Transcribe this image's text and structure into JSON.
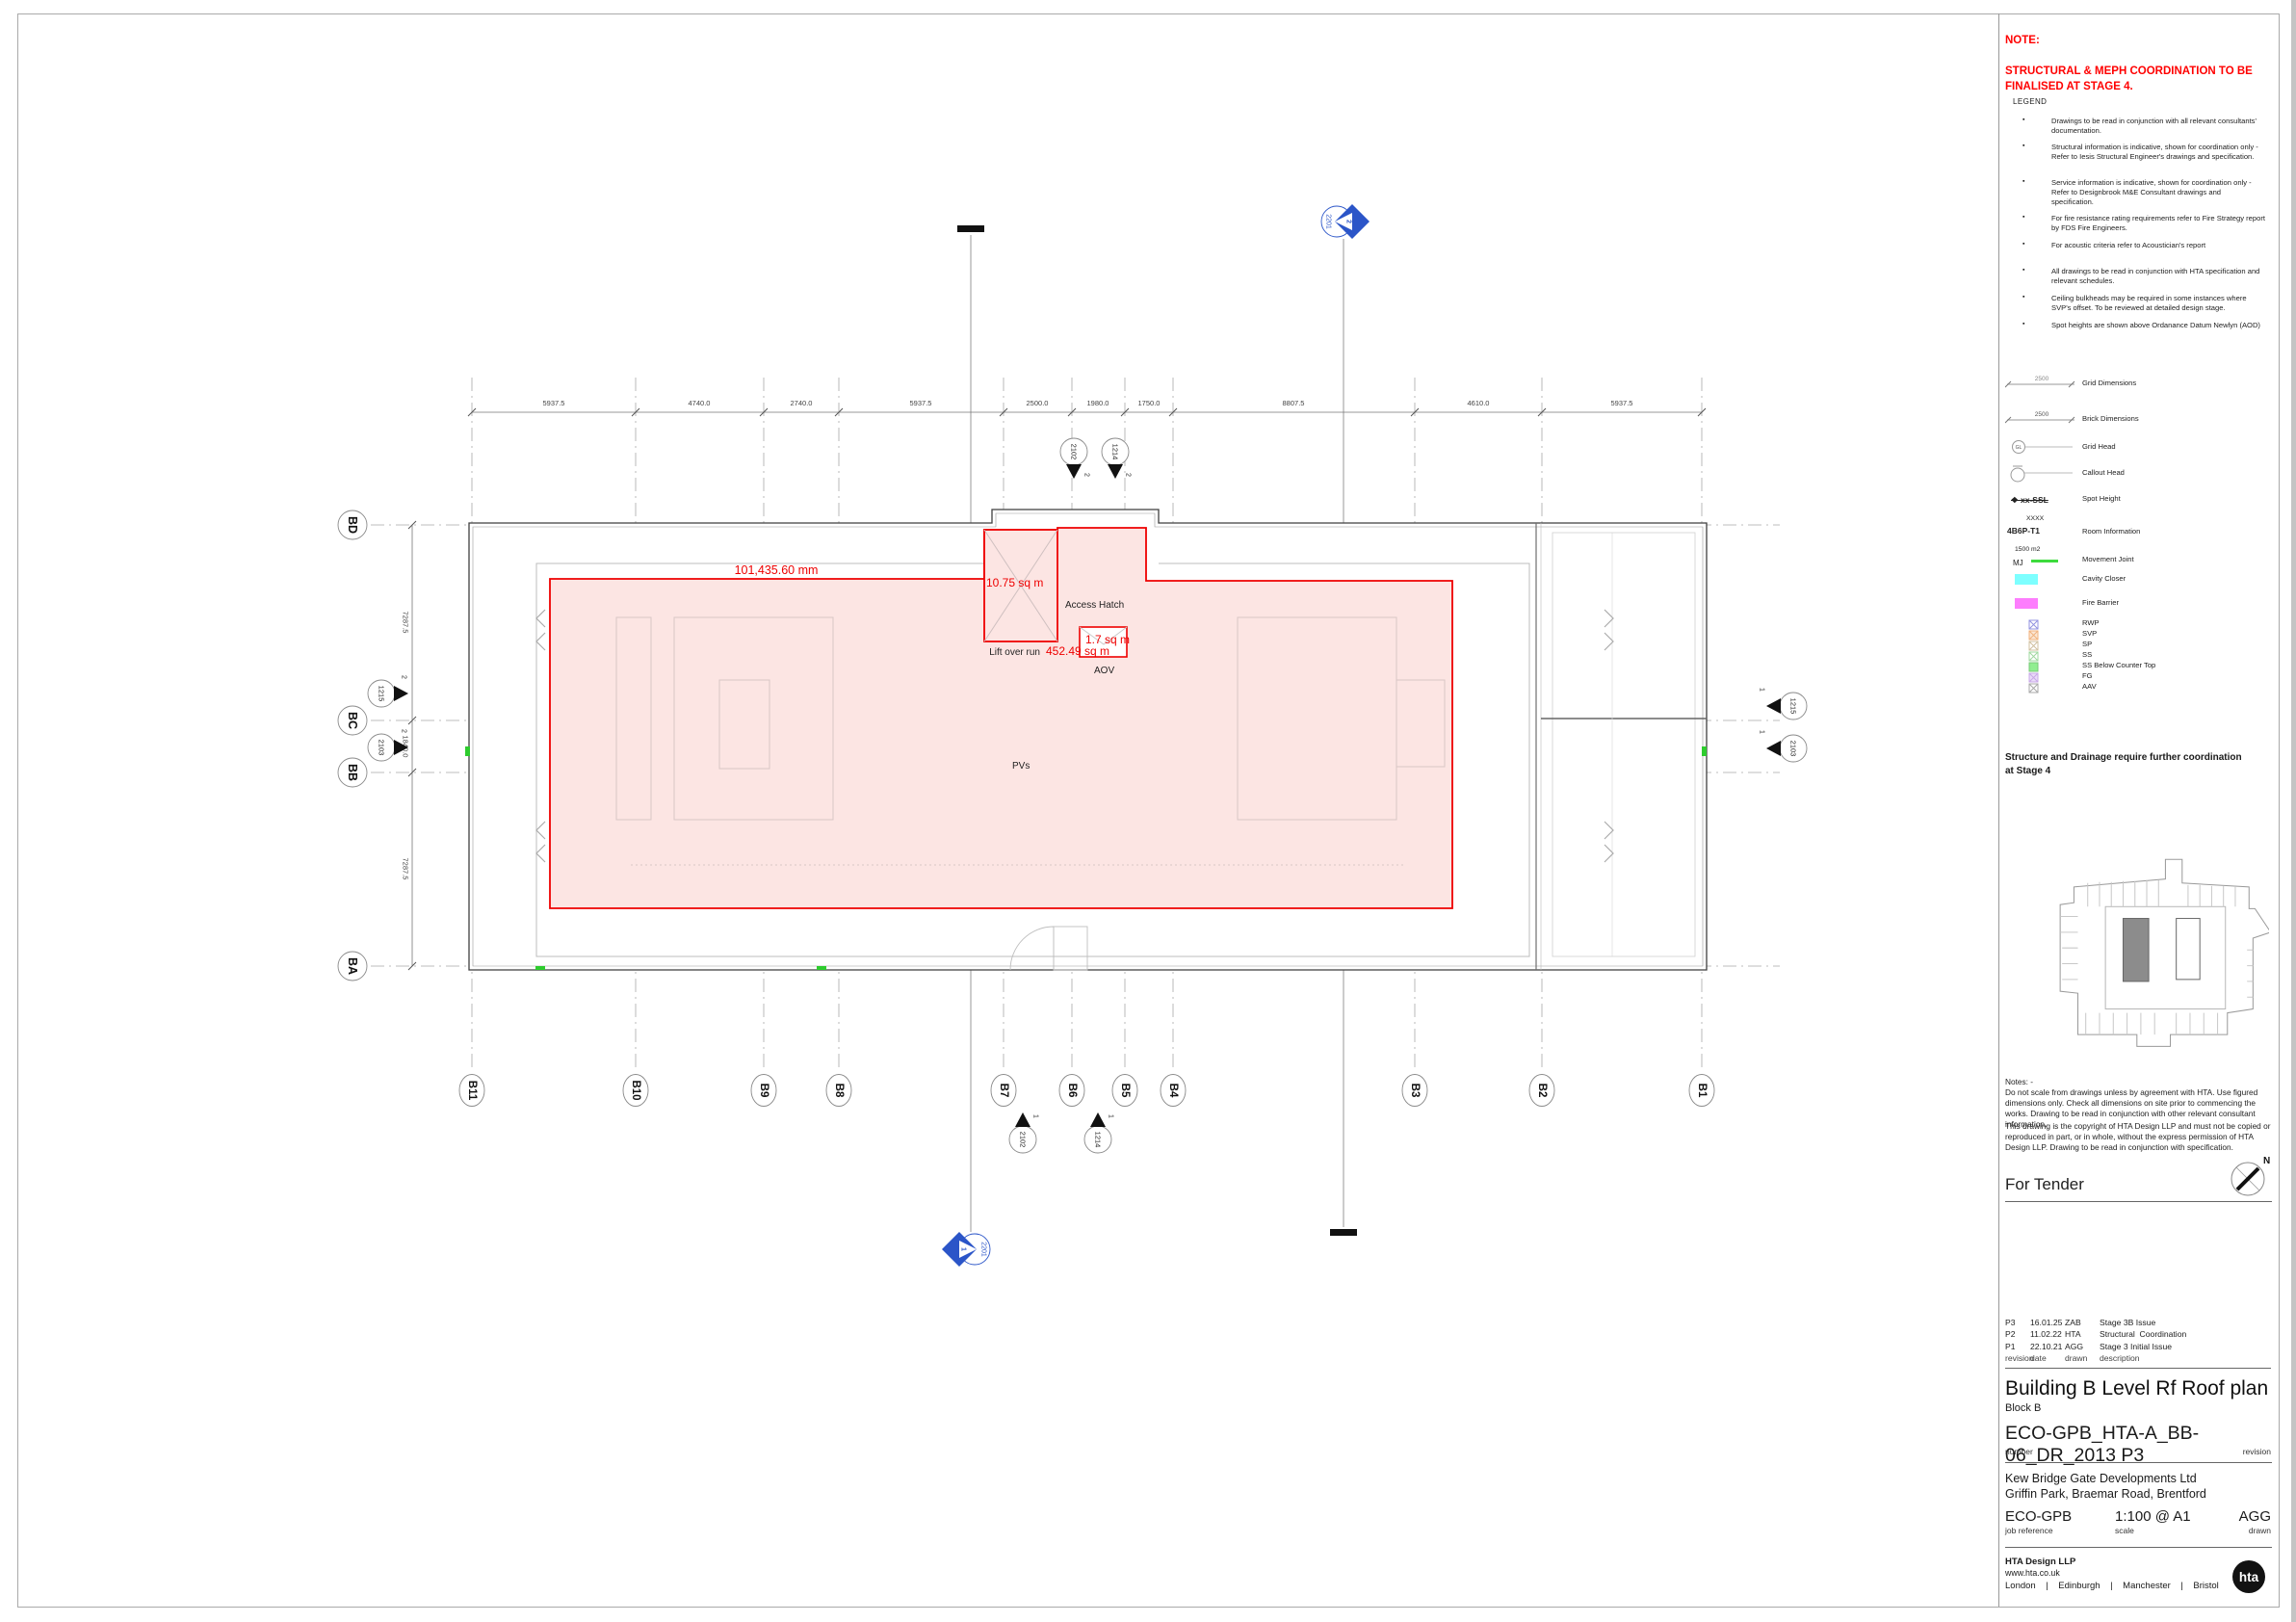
{
  "colors": {
    "annotation_red": "#ee0000",
    "note_red": "#ff0000",
    "pv_area_fill": "#fce5e3",
    "section_marker_blue": "#2b55c8",
    "movement_joint_green": "#3ddb3d",
    "cavity_closer_cyan": "#7dffff",
    "fire_barrier_magenta": "#fd7dfd",
    "keyplan_highlight_gray": "#8c8c8c"
  },
  "note": {
    "title": "NOTE:",
    "body": "STRUCTURAL & MEPH COORDINATION TO BE\nFINALISED AT STAGE 4."
  },
  "legend": {
    "title": "LEGEND",
    "notes": [
      "Drawings to be read in conjunction with all relevant consultants' documentation.",
      "Structural information is indicative, shown for coordination only - Refer to Iesis Structural Engineer's drawings and specification.",
      "Service information is indicative, shown for coordination only - Refer to Designbrook M&E Consultant drawings and specification.",
      "For fire resistance rating requirements refer to Fire Strategy report by FDS Fire Engineers.",
      "For acoustic criteria refer to Acoustician's report",
      "All drawings to be read in conjunction with HTA specification and relevant schedules.",
      "Ceiling bulkheads may be required in some instances where SVP's offset.  To be reviewed at detailed design stage.",
      "Spot heights are shown above Ordanance Datum Newlyn (AOD)"
    ],
    "symbols": [
      {
        "value": "2500",
        "label": "Grid Dimensions"
      },
      {
        "value": "2500",
        "label": "Brick Dimensions"
      },
      {
        "value": "GL",
        "label": "Grid Head"
      },
      {
        "value": "",
        "label": "Callout Head"
      },
      {
        "value": "xx-SSL",
        "value2": "XXXX",
        "label": "Spot Height"
      },
      {
        "value": "4B6P-T1",
        "value2": "1500 m2",
        "label": "Room Information"
      },
      {
        "value": "MJ",
        "label": "Movement Joint"
      },
      {
        "value": "",
        "label": "Cavity Closer"
      },
      {
        "value": "",
        "label": "Fire Barrier"
      },
      {
        "value": "",
        "label": "RWP"
      },
      {
        "value": "",
        "label": "SVP"
      },
      {
        "value": "",
        "label": "SP"
      },
      {
        "value": "",
        "label": "SS"
      },
      {
        "value": "",
        "label": "SS Below Counter Top"
      },
      {
        "value": "",
        "label": "FG"
      },
      {
        "value": "",
        "label": "AAV"
      }
    ]
  },
  "plan": {
    "dims_top": [
      "5937.5",
      "4740.0",
      "2740.0",
      "5937.5",
      "2500.0",
      "1980.0",
      "1750.0",
      "8807.5",
      "4610.0",
      "5937.5"
    ],
    "dims_left": [
      "7287.5",
      "1840.0",
      "7287.5"
    ],
    "grids_bottom": [
      "B11",
      "B10",
      "B9",
      "B8",
      "B7",
      "B6",
      "B5",
      "B4",
      "B3",
      "B2",
      "B1"
    ],
    "grids_left": [
      "BD",
      "BC",
      "BB",
      "BA"
    ],
    "labels": {
      "access_hatch": "Access Hatch",
      "lift_over_run": "Lift over run",
      "aov": "AOV",
      "pvs": "PVs"
    },
    "measurements": {
      "roof_length": "101,435.60 mm",
      "lift_area": "10.75 sq m",
      "pv_area": "452.49 sq m",
      "aov_area": "1.7 sq m"
    },
    "markers": {
      "top": [
        {
          "id": "2102",
          "num": "2"
        },
        {
          "id": "1214",
          "num": "2"
        }
      ],
      "bottom": [
        {
          "id": "2102",
          "num": "1"
        },
        {
          "id": "1214",
          "num": "1"
        }
      ],
      "left": [
        {
          "id": "1215",
          "num": "2"
        },
        {
          "id": "2103",
          "num": "2"
        }
      ],
      "right": [
        {
          "id": "1215",
          "num": "1"
        },
        {
          "id": "2103",
          "num": "1"
        }
      ],
      "section_top": {
        "id": "2201",
        "num": "2"
      },
      "section_bottom": {
        "id": "2201",
        "num": "1"
      }
    }
  },
  "panel": {
    "structure_note": "Structure and Drainage require further coordination\nat Stage 4",
    "notes": "Notes: -\nDo not scale from drawings unless by agreement with HTA. Use figured dimensions only. Check all dimensions on site prior to commencing the works. Drawing to be read in conjunction with other relevant consultant information.",
    "copyright": "This drawing is the copyright of HTA Design LLP and must not be copied or reproduced in part, or in whole, without the express permission of HTA Design LLP. Drawing to be read in conjunction with specification.",
    "status": "For Tender",
    "north_label": "N",
    "revisions": [
      {
        "rev": "P3",
        "date": "16.01.25",
        "drawn": "ZAB",
        "description": "Stage 3B Issue"
      },
      {
        "rev": "P2",
        "date": "11.02.22",
        "drawn": "HTA",
        "description": "Structural  Coordination"
      },
      {
        "rev": "P1",
        "date": "22.10.21",
        "drawn": "AGG",
        "description": "Stage 3 Initial Issue"
      }
    ],
    "revision_headers": {
      "rev": "revision",
      "date": "date",
      "drawn": "drawn",
      "description": "description"
    },
    "title": "Building B Level Rf Roof plan",
    "subtitle": "Block B",
    "number": "ECO-GPB_HTA-A_BB-06_DR_2013 P3",
    "number_label": "number",
    "revision_label": "revision",
    "client": "Kew Bridge Gate Developments Ltd\nGriffin Park, Braemar Road, Brentford",
    "job_reference": "ECO-GPB",
    "job_reference_label": "job reference",
    "scale": "1:100 @ A1",
    "scale_label": "scale",
    "drawn": "AGG",
    "drawn_label": "drawn",
    "firm": "HTA Design LLP",
    "website": "www.hta.co.uk",
    "offices": "London    |    Edinburgh    |    Manchester    |    Bristol",
    "logo_text": "hta"
  }
}
